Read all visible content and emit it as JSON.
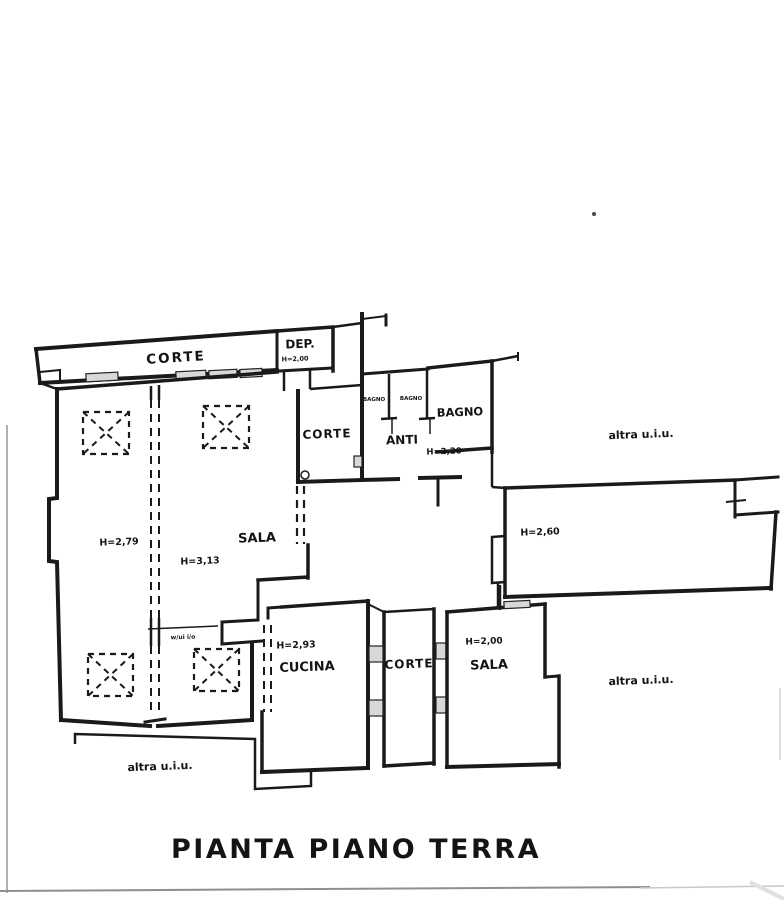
{
  "title": "PIANTA PIANO TERRA",
  "plan": {
    "rooms": {
      "corte_top": "CORTE",
      "dep": "DEP.",
      "dep_h": "H=2,00",
      "corte_mid": "CORTE",
      "anti": "ANTI",
      "anti_h": "H=2,20",
      "bagno": "BAGNO",
      "bagno_small_left": "BAGNO",
      "bagno_small_right": "BAGNO",
      "left_room_h": "H=2,79",
      "sala_main": "SALA",
      "sala_main_h": "H=3,13",
      "right_room_h": "H=2,60",
      "cucina": "CUCINA",
      "cucina_h": "H=2,93",
      "corte_bottom": "CORTE",
      "sala_bottom": "SALA",
      "sala_bottom_h": "H=2,00"
    },
    "external_labels": {
      "right_top": "altra u.i.u.",
      "right_bottom": "altra u.i.u.",
      "bottom_left": "altra u.i.u."
    },
    "annotation": "w/ui i/o"
  },
  "colors": {
    "ink": "#1a1a1a",
    "paper": "#ffffff",
    "scan_edge": "#9c9c9c",
    "window_fill": "#d8d8d8"
  }
}
